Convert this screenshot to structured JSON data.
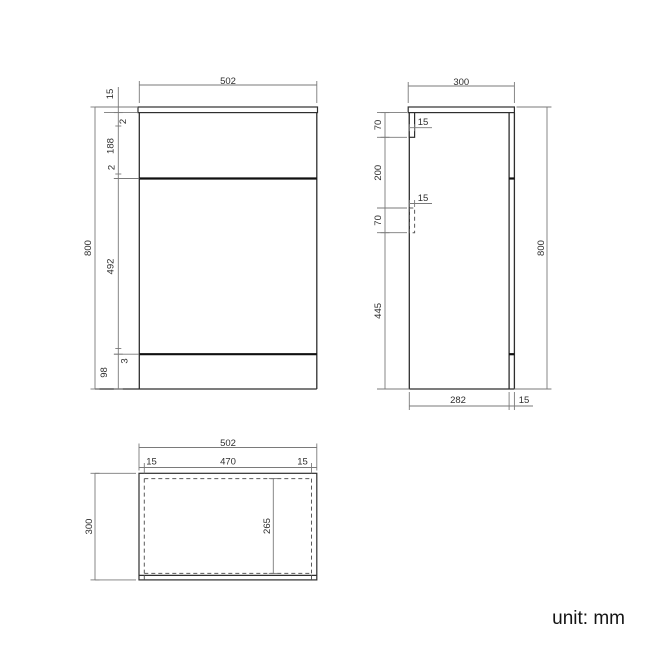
{
  "unit_label": "unit: mm",
  "front_view": {
    "width_label": "502",
    "worktop_thickness": "15",
    "top_gap": "2",
    "drawer_height": "188",
    "mid_gap": "2",
    "door_height": "492",
    "bottom_gap": "3",
    "plinth_height": "98",
    "total_height": "800"
  },
  "side_view": {
    "depth_label": "300",
    "upper_bracket_height": "70",
    "upper_bracket_width": "15",
    "bracket_spacing": "200",
    "lower_bracket_width": "15",
    "lower_bracket_height": "70",
    "lower_section_height": "445",
    "total_height": "800",
    "body_depth": "282",
    "back_panel_thickness": "15"
  },
  "top_view": {
    "width_label": "502",
    "left_panel_thickness": "15",
    "interior_width": "470",
    "right_panel_thickness": "15",
    "depth_label": "300",
    "interior_depth": "265"
  }
}
